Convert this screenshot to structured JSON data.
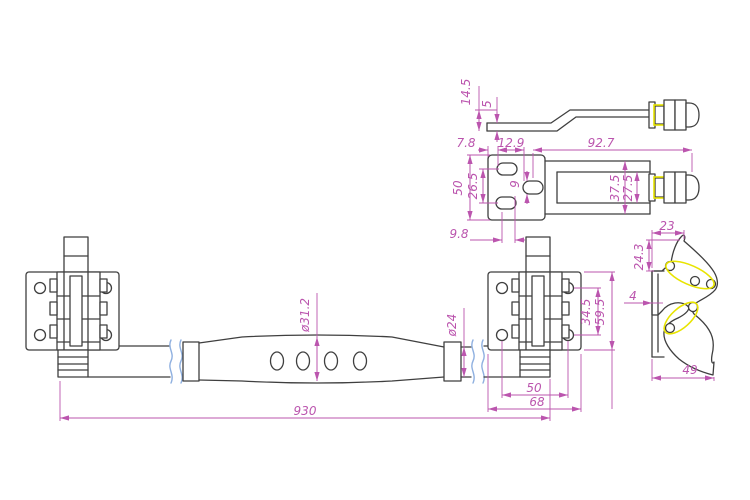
{
  "meta": {
    "drawing_type": "technical-drawing"
  },
  "colors": {
    "line": "#3f3f3f",
    "dimension": "#bb55ae",
    "break": "#8fb0e0",
    "highlight": "#e8e400",
    "thread": "#e8963c"
  },
  "views": {
    "arm_side": {
      "label": "lock-arm-side-view",
      "dims": {
        "total_height": "14.5",
        "plate_thickness": "5"
      }
    },
    "arm_plan": {
      "label": "lock-arm-plan-view",
      "dims": {
        "edge_to_slot": "7.8",
        "slot_pitch": "12.9",
        "arm_length": "92.7",
        "plate_width": "50",
        "slot_spacing": "26.5",
        "slot_width": "9",
        "channel_outer": "37.5",
        "channel_inner": "27.5",
        "bottom_offset": "9.8"
      }
    },
    "cam": {
      "label": "cam-keeper-view",
      "dims": {
        "top_width": "23",
        "tip_height": "24.3",
        "flange_thickness": "4",
        "overall_width": "49"
      }
    },
    "assembly": {
      "label": "rod-assembly-view",
      "dims": {
        "tube_diameter": "ø31.2",
        "rod_diameter": "ø24",
        "hole_spacing_vertical": "34.5",
        "bracket_height": "59.5",
        "hole_spacing_horizontal": "50",
        "bracket_width": "68",
        "overall_length": "930"
      }
    }
  }
}
